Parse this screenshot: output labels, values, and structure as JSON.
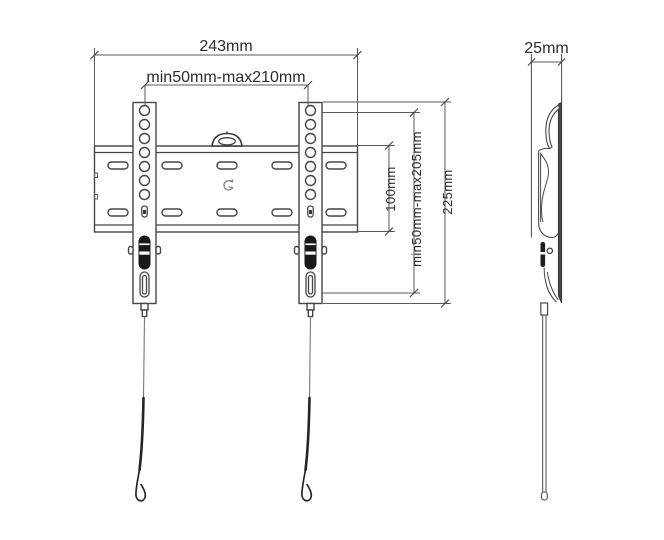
{
  "front_view": {
    "overall_width": "243mm",
    "vesa_width_range": "min50mm-max210mm",
    "plate_height": "100mm",
    "vesa_height_range": "min50mm-max205mm",
    "bracket_height": "225mm"
  },
  "side_view": {
    "depth": "25mm"
  },
  "colors": {
    "line": "#454545",
    "dim_line": "#5a5a5a",
    "dark_fill": "#1a1a1a",
    "text": "#2b2b2b",
    "background": "#ffffff"
  }
}
